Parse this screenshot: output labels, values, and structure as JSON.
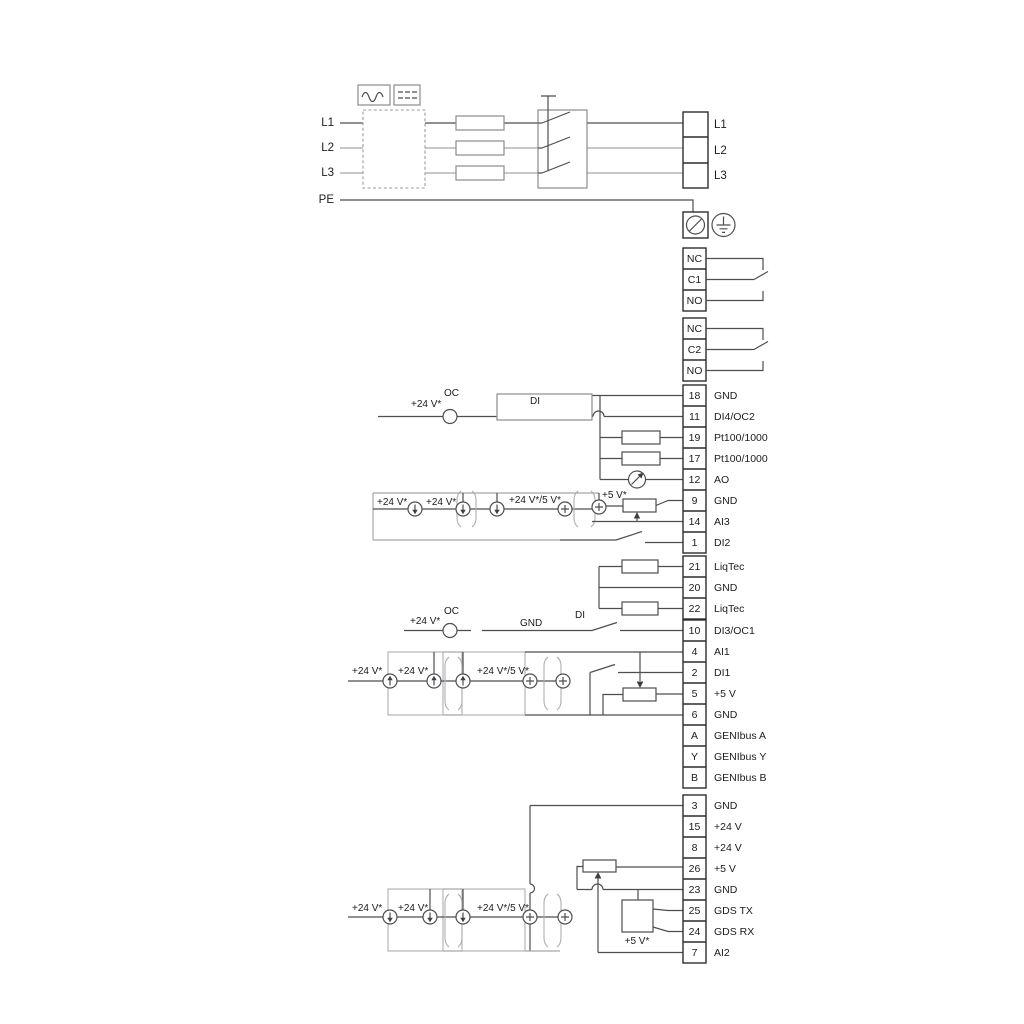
{
  "mains": {
    "left": [
      "L1",
      "L2",
      "L3",
      "PE"
    ],
    "right": [
      "L1",
      "L2",
      "L3"
    ]
  },
  "relay1": {
    "rows": [
      "NC",
      "C1",
      "NO"
    ]
  },
  "relay2": {
    "rows": [
      "NC",
      "C2",
      "NO"
    ]
  },
  "strip_a": {
    "rows": [
      {
        "num": "18",
        "label": "GND"
      },
      {
        "num": "11",
        "label": "DI4/OC2"
      },
      {
        "num": "19",
        "label": "Pt100/1000"
      },
      {
        "num": "17",
        "label": "Pt100/1000"
      },
      {
        "num": "12",
        "label": "AO"
      },
      {
        "num": "9",
        "label": "GND"
      },
      {
        "num": "14",
        "label": "AI3"
      },
      {
        "num": "1",
        "label": "DI2"
      }
    ]
  },
  "liqtec": {
    "rows": [
      {
        "num": "21",
        "label": "LiqTec"
      },
      {
        "num": "20",
        "label": "GND"
      },
      {
        "num": "22",
        "label": "LiqTec"
      }
    ]
  },
  "strip_b": {
    "rows": [
      {
        "num": "10",
        "label": "DI3/OC1"
      },
      {
        "num": "4",
        "label": "AI1"
      },
      {
        "num": "2",
        "label": "DI1"
      },
      {
        "num": "5",
        "label": "+5 V"
      },
      {
        "num": "6",
        "label": "GND"
      },
      {
        "num": "A",
        "label": "GENIbus A"
      },
      {
        "num": "Y",
        "label": "GENIbus Y"
      },
      {
        "num": "B",
        "label": "GENIbus B"
      }
    ]
  },
  "strip_c": {
    "rows": [
      {
        "num": "3",
        "label": "GND"
      },
      {
        "num": "15",
        "label": "+24 V"
      },
      {
        "num": "8",
        "label": "+24 V"
      },
      {
        "num": "26",
        "label": "+5 V"
      },
      {
        "num": "23",
        "label": "GND"
      },
      {
        "num": "25",
        "label": "GDS TX"
      },
      {
        "num": "24",
        "label": "GDS RX"
      },
      {
        "num": "7",
        "label": "AI2"
      }
    ]
  },
  "ann": {
    "v24": "+24 V*",
    "v24v5": "+24 V*/5 V*",
    "v5": "+5 V*",
    "oc": "OC",
    "di": "DI",
    "gnd": "GND"
  },
  "colors": {
    "wire_dark": "#4d4e50",
    "wire_gray": "#a6a7aa",
    "text": "#1c1c1e"
  }
}
